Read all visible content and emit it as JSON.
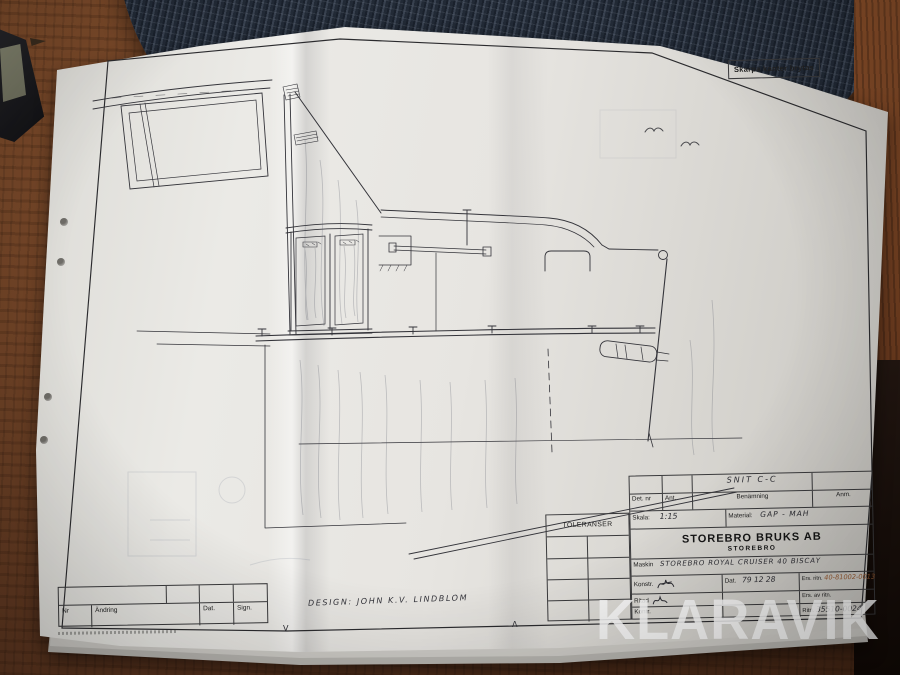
{
  "watermark": {
    "text": "KLARAVIK"
  },
  "sheet": {
    "corner_note": "Skarpa kanter brytas",
    "section_label": "SNIT C-C",
    "design_credit": "DESIGN: JOHN K.V. LINDBLOM",
    "fold_mark_down": "V",
    "fold_mark_up": "Λ",
    "title_block": {
      "toleranser_label": "TOLERANSER",
      "det_nr_label": "Det. nr",
      "ant_label": "Ant.",
      "benamning_label": "Benämning",
      "anm_label": "Anm.",
      "skala_label": "Skala:",
      "skala_value": "1:15",
      "material_label": "Material:",
      "material_value": "GAP - MAH",
      "company_name": "STOREBRO BRUKS AB",
      "company_city": "STOREBRO",
      "maskin_label": "Maskin",
      "maskin_value": "STOREBRO ROYAL CRUISER 40 BISCAY",
      "konstr_label": "Konstr.",
      "ritad_label": "Ritad",
      "kontr_label": "Kontr.",
      "dat_label": "Dat.",
      "dat_value": "79 12 28",
      "ers_ritn_label": "Ers. ritn.",
      "ers_ritn_value": "40-81002-0013",
      "ers_av_ritn_label": "Ers. av ritn.",
      "ritn_label": "Ritn.",
      "ritn_value": "35510-0024"
    },
    "revision_table": {
      "headers": [
        "Nr",
        "Ändring",
        "Dat.",
        "Sign."
      ]
    }
  },
  "colors": {
    "placemat": "#242d3a",
    "wood": "#7b4a2a",
    "paper": "#e7e5e1",
    "ink": "#34343a"
  }
}
